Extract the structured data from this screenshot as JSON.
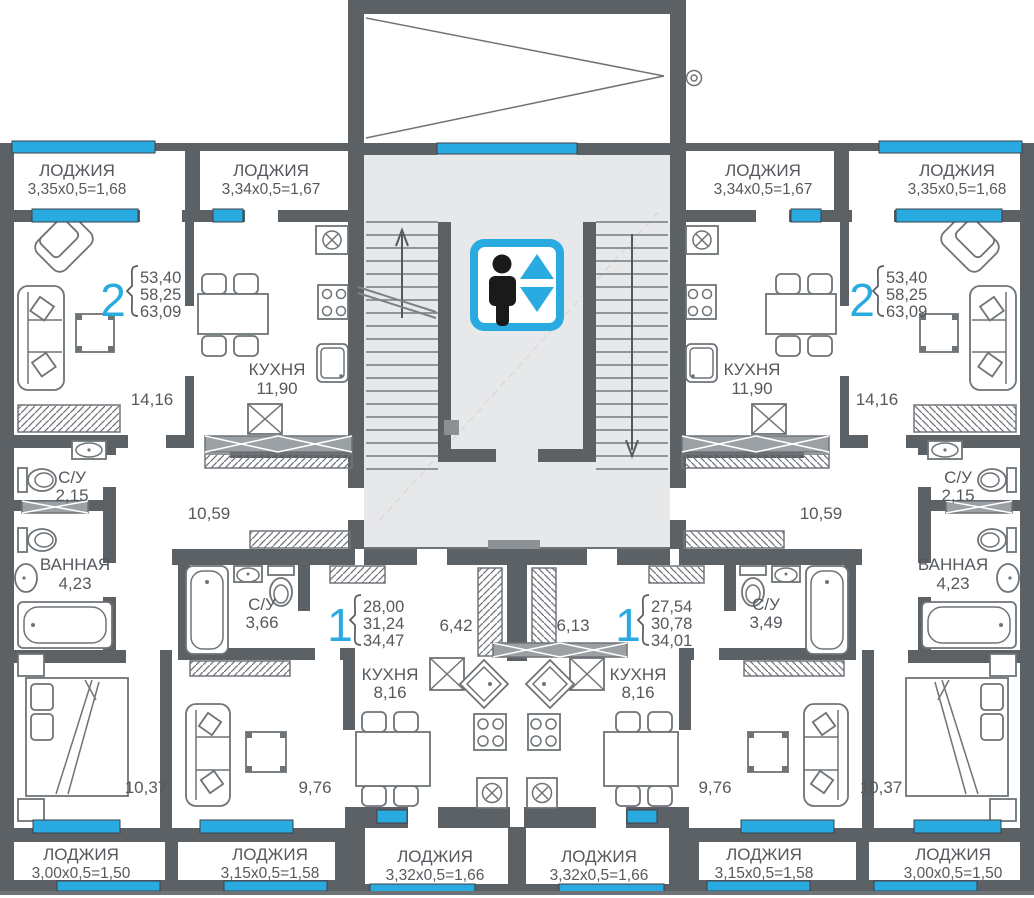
{
  "colors": {
    "accent": "#29abe2",
    "wall": "#5c6166",
    "hall_fill": "#e7e8e9",
    "line": "#6e7377",
    "text": "#55595d"
  },
  "loggias": {
    "top_left_outer": {
      "label": "ЛОДЖИЯ",
      "dims": "3,35x0,5=1,68"
    },
    "top_left_inner": {
      "label": "ЛОДЖИЯ",
      "dims": "3,34x0,5=1,67"
    },
    "top_right_inner": {
      "label": "ЛОДЖИЯ",
      "dims": "3,34x0,5=1,67"
    },
    "top_right_outer": {
      "label": "ЛОДЖИЯ",
      "dims": "3,35x0,5=1,68"
    },
    "bottom_left_outer": {
      "label": "ЛОДЖИЯ",
      "dims": "3,00x0,5=1,50"
    },
    "bottom_left_mid": {
      "label": "ЛОДЖИЯ",
      "dims": "3,15x0,5=1,58"
    },
    "bottom_center_left": {
      "label": "ЛОДЖИЯ",
      "dims": "3,32x0,5=1,66"
    },
    "bottom_center_right": {
      "label": "ЛОДЖИЯ",
      "dims": "3,32x0,5=1,66"
    },
    "bottom_right_mid": {
      "label": "ЛОДЖИЯ",
      "dims": "3,15x0,5=1,58"
    },
    "bottom_right_outer": {
      "label": "ЛОДЖИЯ",
      "dims": "3,00x0,5=1,50"
    }
  },
  "apartments": {
    "left_two_room": {
      "number": "2",
      "areas": [
        "53,40",
        "58,25",
        "63,09"
      ]
    },
    "right_two_room": {
      "number": "2",
      "areas": [
        "53,40",
        "58,25",
        "63,09"
      ]
    },
    "left_one_room": {
      "number": "1",
      "areas": [
        "28,00",
        "31,24",
        "34,47"
      ]
    },
    "right_one_room": {
      "number": "1",
      "areas": [
        "27,54",
        "30,78",
        "34,01"
      ]
    }
  },
  "rooms": {
    "left_two_room": {
      "living": "14,16",
      "kitchen_label": "КУХНЯ",
      "kitchen": "11,90",
      "wc_label": "С/У",
      "wc": "2,15",
      "bath_label": "ВАННАЯ",
      "bath": "4,23",
      "hall": "10,59",
      "bedroom": "10,37"
    },
    "right_two_room": {
      "living": "14,16",
      "kitchen_label": "КУХНЯ",
      "kitchen": "11,90",
      "wc_label": "С/У",
      "wc": "2,15",
      "bath_label": "ВАННАЯ",
      "bath": "4,23",
      "hall": "10,59",
      "bedroom": "10,37"
    },
    "left_one_room": {
      "wc_label": "С/У",
      "wc": "3,66",
      "hall": "6,42",
      "kitchen_label": "КУХНЯ",
      "kitchen": "8,16",
      "living": "9,76"
    },
    "right_one_room": {
      "wc_label": "С/У",
      "wc": "3,49",
      "hall": "6,13",
      "kitchen_label": "КУХНЯ",
      "kitchen": "8,16",
      "living": "9,76"
    }
  }
}
